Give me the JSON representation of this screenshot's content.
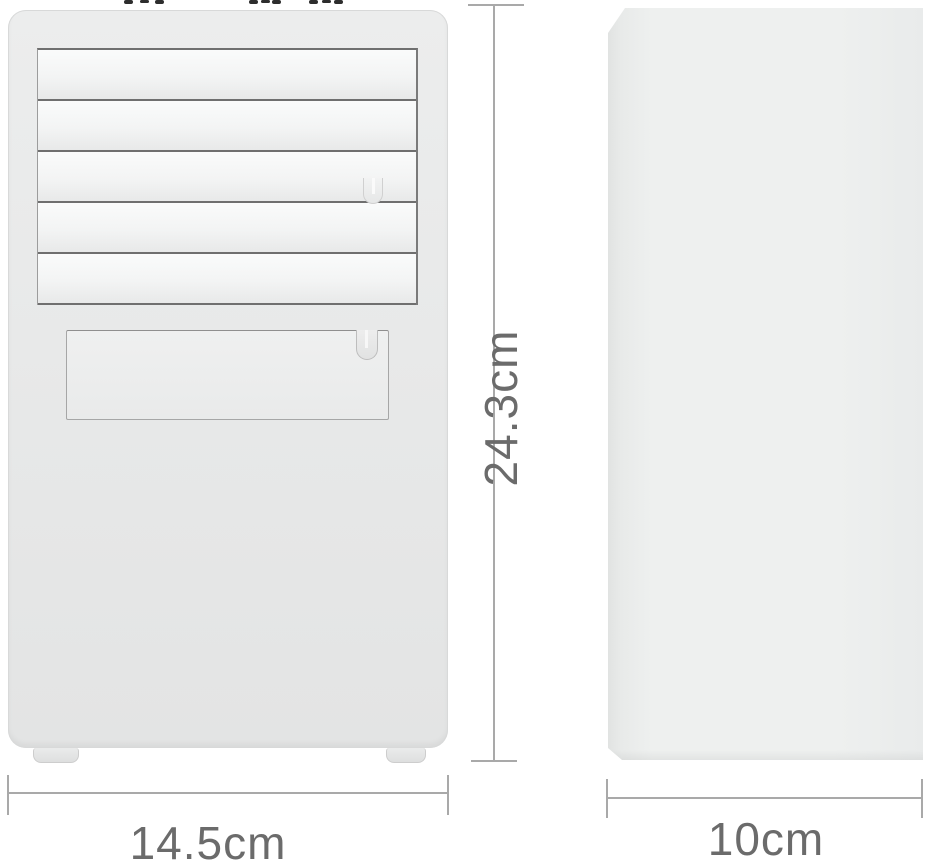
{
  "diagram": {
    "kind": "product-dimension-diagram",
    "views": {
      "front": {
        "height_label": "24.3cm",
        "width_label": "14.5cm",
        "louver_slat_count": 5
      },
      "side": {
        "depth_label": "10cm"
      }
    },
    "dimensions": {
      "height_cm": 24.3,
      "width_cm": 14.5,
      "depth_cm": 10
    },
    "colors": {
      "background": "#ffffff",
      "device_body": "#e9eaea",
      "slat_face": "#f5f6f6",
      "louver_line": "#6f6f6f",
      "dimension_line": "#a9a9a9",
      "dimension_text": "#6b6b6b"
    }
  }
}
